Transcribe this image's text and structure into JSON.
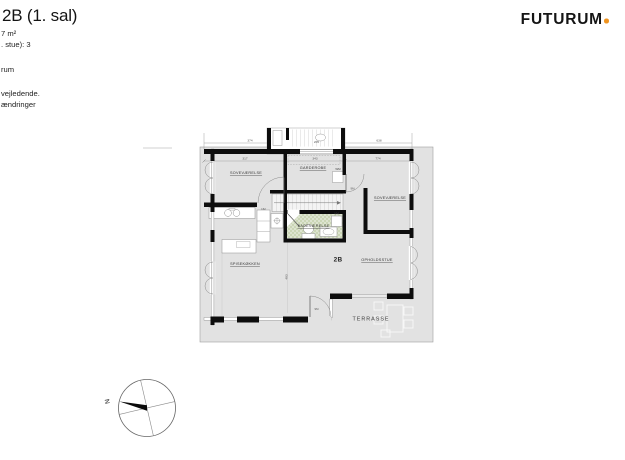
{
  "header": {
    "title": "2B (1. sal)",
    "area_line": "7 m²",
    "rooms_line": ". stue): 3",
    "floor_line": "rum",
    "note_line1": "vejledende.",
    "note_line2": "ændringer"
  },
  "logo": {
    "wordmark": "FUTURUM"
  },
  "plan": {
    "unit": "2B",
    "room_labels": {
      "bedroom_left": "SOVEVÆRELSE",
      "wardrobe": "GARDEROBE",
      "bedroom_right": "SOVEVÆRELSE",
      "bathroom": "BADEVÆRELSE",
      "kitchen": "SPISEKØKKEN",
      "living_room": "OPHOLDSSTUE",
      "terrace": "TERRASSE"
    },
    "appliance_labels": {
      "washer": "WM",
      "washer2": "VM"
    },
    "door_labels": {
      "hall": "9M",
      "terrace": "9M",
      "kitchen": "162"
    },
    "dimensions": {
      "top_left": "374",
      "stair": "205",
      "top_right": "638",
      "inner_left": "317",
      "inner_mid": "343",
      "inner_right": "774",
      "living_vertical": "483"
    },
    "compass": {
      "north": "N"
    }
  },
  "colors": {
    "plot": "#e2e2e2",
    "wall": "#0d0d0d",
    "tile_light": "#dde4d0",
    "tile_dark": "#cbd6b6",
    "logo_dot": "#f0941f"
  }
}
